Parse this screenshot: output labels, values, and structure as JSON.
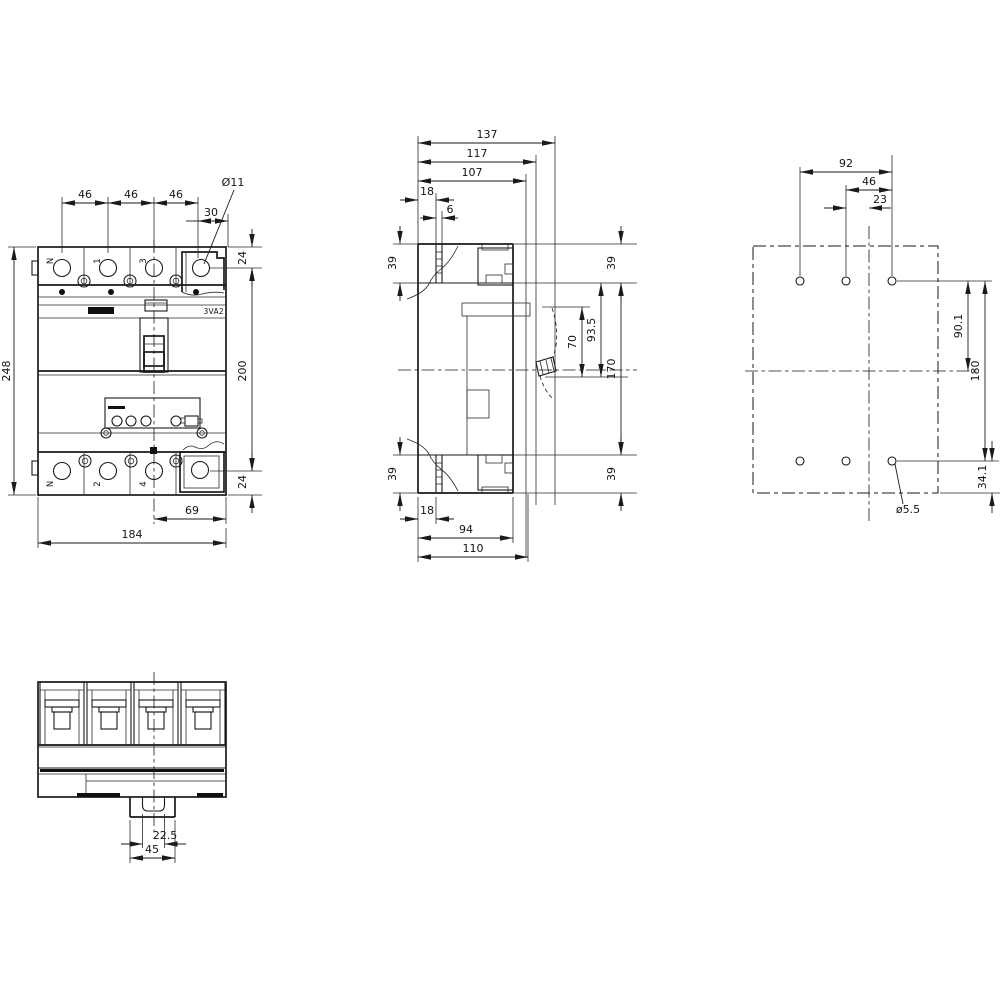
{
  "front": {
    "pitch_1": "46",
    "pitch_2": "46",
    "pitch_3": "46",
    "hole_offset": "30",
    "hole_dia": "Ø11",
    "height": "248",
    "edge_top": "24",
    "row_spacing": "200",
    "edge_bottom": "24",
    "center_to_edge": "69",
    "width": "184",
    "series_label": "3VA2",
    "top_terminals": [
      "N",
      "1",
      "3"
    ],
    "bottom_terminals": [
      "N",
      "2",
      "4"
    ]
  },
  "side": {
    "depth_overall": "137",
    "depth_117": "117",
    "depth_107": "107",
    "front_step_18": "18",
    "front_step_6": "6",
    "shroud_top_left": "39",
    "shroud_bottom_left": "39",
    "shroud_top_right": "39",
    "shroud_bottom_right": "39",
    "contact_70": "70",
    "contact_93_5": "93.5",
    "body_170": "170",
    "rear_step_18": "18",
    "rear_94": "94",
    "rear_110": "110"
  },
  "drill": {
    "span_92": "92",
    "pitch_46": "46",
    "offset_23": "23",
    "center_90_1": "90.1",
    "rows_180": "180",
    "edge_34_1": "34.1",
    "hole_dia": "ø5.5"
  },
  "bottom_view": {
    "slot_22_5": "22.5",
    "rail_45": "45"
  }
}
